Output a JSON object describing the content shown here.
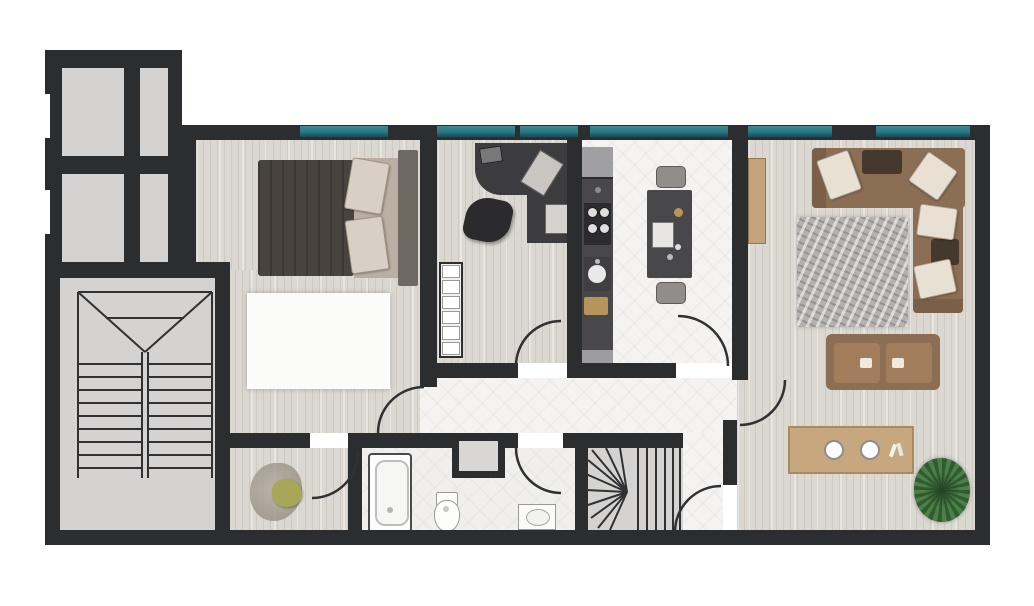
{
  "diagram_type": "apartment-floor-plan",
  "visible_text": [],
  "palette": {
    "wall": "#2b2d2f",
    "wood_floor": "#dbd7d1",
    "tile_floor": "#f4f3f2",
    "bath_floor": "#f0efee",
    "common_floor": "#d5d3d1",
    "stair_line": "#2f3132",
    "window_teal": "#2e7b85",
    "window_teal_dark": "#154e58",
    "rug_white": "#fbfbfa",
    "rug_gray": "#b5b2ae",
    "bed_duvet": "#49433d",
    "bed_pillow": "#d9d0c5",
    "bed_back_pillow": "#b9afa3",
    "headboard": "#6e6962",
    "desk": "#3c3c3e",
    "chair": "#2b2b2d",
    "counter": "#48484a",
    "appliance": "#2c2c2e",
    "fridge": "#a0a0a2",
    "sink_white": "#e9e9e9",
    "board_gold": "#b5955c",
    "stool": "#908d8a",
    "sofa": "#8c6e54",
    "sofa_arm": "#7a6049",
    "cushion_cream": "#e8e0d3",
    "cushion_dark": "#45382c",
    "seat_tan": "#a27d5c",
    "table_wood": "#c7a87e",
    "table_border": "#a98a62",
    "chair_dark": "#30271f",
    "console_wood": "#c2a37c",
    "plant_green": "#6f9e50",
    "plant_dark": "#2f5d31",
    "plant_mid": "#4d7f46",
    "fixture_white": "#ffffff",
    "fixture_border": "#9a9a98",
    "radiator": "#f2f1ef",
    "shaft_gray": "#d9d7d5",
    "closet_blob": "#9a9488",
    "closet_olive": "#a8a757"
  },
  "floor_plan": {
    "common_areas": [
      {
        "id": "elevator-shafts",
        "elements": [
          "four-gray-compartments",
          "left-wall-window-notches"
        ]
      },
      {
        "id": "main-stairwell",
        "elements": [
          "double-flight-stairs",
          "v-landing",
          "center-divider"
        ]
      }
    ],
    "rooms": [
      {
        "id": "bedroom",
        "furniture": [
          "plant",
          "double-bed-with-pillows",
          "headboard",
          "white-area-rug"
        ],
        "window": true
      },
      {
        "id": "closet-room",
        "furniture": [
          "clothes-pile",
          "olive-beanbag"
        ],
        "door": "from-bedroom"
      },
      {
        "id": "office",
        "furniture": [
          "l-shaped-desk",
          "laptop",
          "desk-pads",
          "office-chair",
          "radiator",
          "plant"
        ],
        "window": true,
        "door": "to-hallway"
      },
      {
        "id": "kitchen",
        "furniture": [
          "fridge",
          "stove-4-burners",
          "sink",
          "cutting-board",
          "island",
          "two-stools"
        ],
        "window": true,
        "door": "to-hallway"
      },
      {
        "id": "hallway",
        "furniture": [],
        "connects": [
          "bedroom",
          "office",
          "kitchen",
          "bathroom",
          "living-room",
          "vestibule"
        ]
      },
      {
        "id": "bathroom",
        "furniture": [
          "bathtub",
          "service-shaft",
          "toilet",
          "sink"
        ],
        "door": "from-hallway"
      },
      {
        "id": "winder-staircase",
        "furniture": [
          "fan-steps",
          "straight-steps"
        ]
      },
      {
        "id": "vestibule",
        "furniture": [],
        "door": "to-dining"
      },
      {
        "id": "living-room",
        "furniture": [
          "wall-console",
          "l-shaped-sofa",
          "cream-pillows",
          "dark-cushions",
          "gray-area-rug",
          "two-seat-sofa"
        ],
        "window": true
      },
      {
        "id": "dining-area",
        "furniture": [
          "wood-table",
          "six-dark-chairs",
          "two-plates",
          "cutlery",
          "large-plant"
        ]
      }
    ],
    "doors": [
      "bedroom-to-hallway",
      "office-to-hallway",
      "kitchen-to-hallway",
      "hallway-to-living-room",
      "hallway-to-bathroom",
      "bedroom-to-closet",
      "vestibule-to-dining"
    ],
    "windows_teal_segments": 6
  }
}
